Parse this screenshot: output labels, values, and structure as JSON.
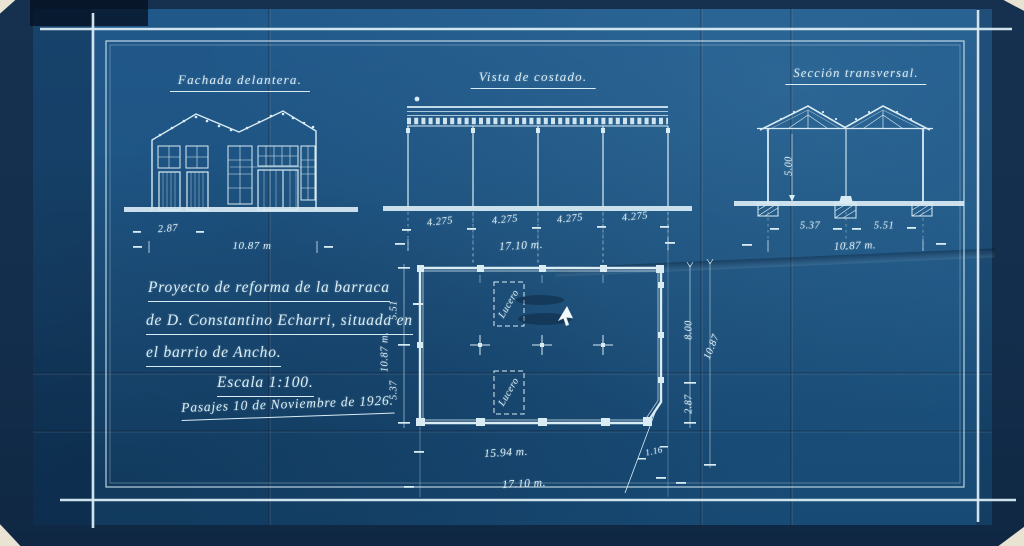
{
  "blueprint": {
    "views": {
      "front_elevation": {
        "title": "Fachada delantera.",
        "dims": {
          "bay": "2.87",
          "total": "10.87 m"
        }
      },
      "side_elevation": {
        "title": "Vista de costado.",
        "dims": {
          "bays": [
            "4.275",
            "4.275",
            "4.275",
            "4.275"
          ],
          "total": "17.10 m."
        }
      },
      "cross_section": {
        "title": "Sección transversal.",
        "dims": {
          "height": "5.00",
          "left": "5.37",
          "right": "5.51",
          "total": "10.87 m."
        }
      },
      "floor_plan": {
        "skylight1": "Lucero",
        "skylight2": "Lucero",
        "dims": {
          "left_top": "5.51",
          "left_total": "10.87 m.",
          "left_bottom": "5.37",
          "right_top": "8.00",
          "right_total": "10.87",
          "right_bottom": "2.87",
          "bottom_inner": "15.94 m.",
          "bottom_total": "17.10 m.",
          "chamfer": "1.16"
        }
      }
    },
    "title_block": {
      "line1": "Proyecto de reforma de la barraca",
      "line2": "de D. Constantino Echarri, situada en",
      "line3": "el barrio de Ancho.",
      "scale": "Escala 1:100.",
      "date": "Pasajes 10 de Noviembre de 1926."
    },
    "colors": {
      "paper": "#1d5380",
      "paper_dark": "#132e4c",
      "ink": "#d9ecf4",
      "scan_background": "#e9e3d3"
    }
  }
}
